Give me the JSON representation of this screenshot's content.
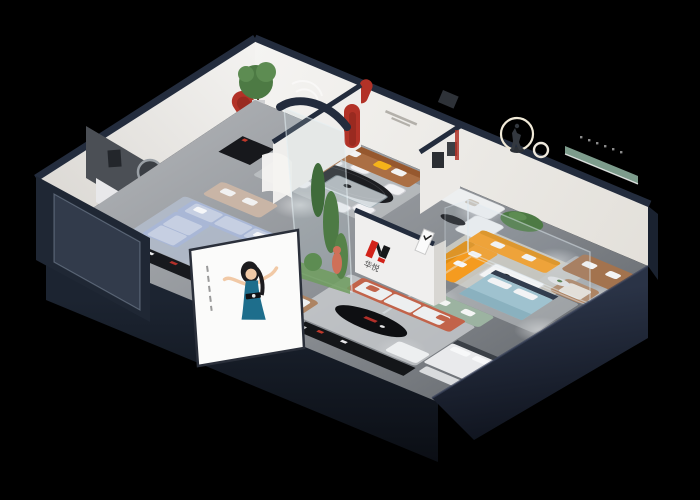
{
  "scene": {
    "type": "isometric-showroom-cutaway-render",
    "brand": {
      "logo_text": "华悦",
      "logo_mark": "red-black-H-monogram"
    },
    "poster": {
      "subject": "illustrated-woman-in-teal-dress",
      "background": "white"
    },
    "features": [
      "dining-vignette-black-oval-table",
      "brown-leather-sofa-vignette",
      "white-sofa-vignette-with-tree",
      "orange-sectional-vignette",
      "ring-light-sculpture",
      "green-wall-shelf-lounge",
      "teal-bed-glass-suite",
      "terracotta-sofa-living",
      "powder-blue-sectional-room",
      "glass-plant-enclosure",
      "red-arch-niches",
      "brand-logo-wall",
      "street-poster-billboard"
    ]
  },
  "colors": {
    "bg": "#000000",
    "floor-light": "#a6a9ad",
    "floor-dark": "#767a7f",
    "wall-face": "#f2f1ee",
    "wall-shade": "#e0ddd7",
    "wall-cap": "#232c3d",
    "outer-navy": "#1d2532",
    "outer-navy-deep": "#12161f",
    "accent-red": "#b23227",
    "logo-red": "#d2231a",
    "logo-black": "#17181a",
    "orange-sofa": "#f59b1f",
    "orange-shade": "#e08d12",
    "brown-leather": "#ab6f44",
    "brown-shade": "#96582e",
    "tan-chair": "#ad8463",
    "rc-leather": "#a3734e",
    "blue-sofa": "#a9b7d6",
    "blue-cushion": "#c6cfe2",
    "sage-sofa": "#9cb3a1",
    "teal-bed": "#9fc2cf",
    "headboard-navy": "#323d4e",
    "terracotta": "#c2634a",
    "white-fabric": "#edeff0",
    "rug-warm": "#d8d4c8",
    "rug-cool": "#cbced0",
    "rug-blue": "#b7c2d4",
    "green-plant": "#4d7a44",
    "green-plant-light": "#5d8c52",
    "green-shelf": "#7d9c8c",
    "dark-furniture": "#17181c",
    "gray-accent-wall": "#4b4f55",
    "dress-teal": "#1e6e8c",
    "skin": "#f1c9a6",
    "hair": "#1c1b1e",
    "yellow-pillow": "#f5b31a"
  }
}
